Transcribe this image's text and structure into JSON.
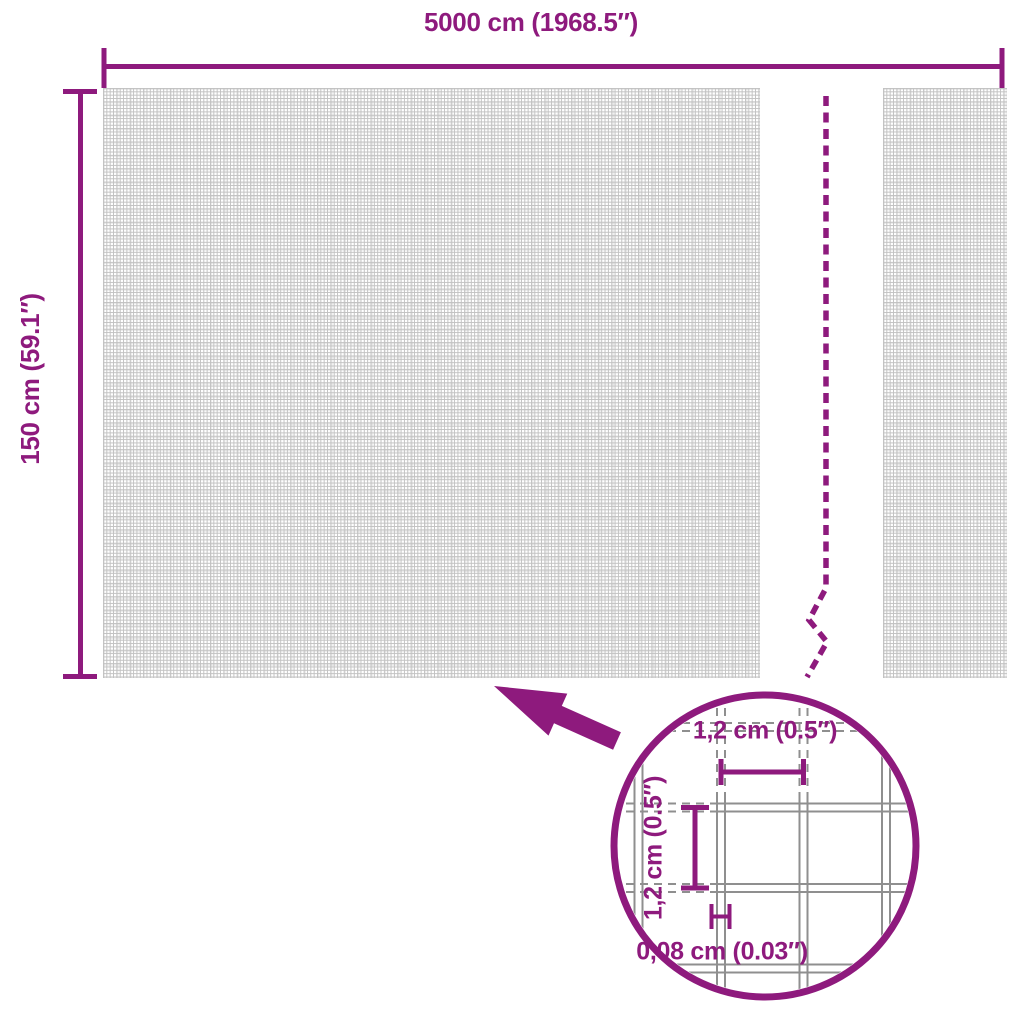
{
  "colors": {
    "accent": "#8E1A7D",
    "mesh_line": "#C2C2C2",
    "wire_line": "#8F8F8F"
  },
  "dimensions": {
    "width_label": "5000 cm (1968.5″)",
    "height_label": "150 cm (59.1″)"
  },
  "detail": {
    "mesh_width_label": "1,2 cm (0.5″)",
    "mesh_height_label": "1,2 cm (0.5″)",
    "wire_thickness_label": "0,08 cm (0.03″)"
  },
  "icons": {
    "detail_arrow": "thick-arrow-up-left",
    "detail_magnifier": "circle-magnified-mesh"
  }
}
